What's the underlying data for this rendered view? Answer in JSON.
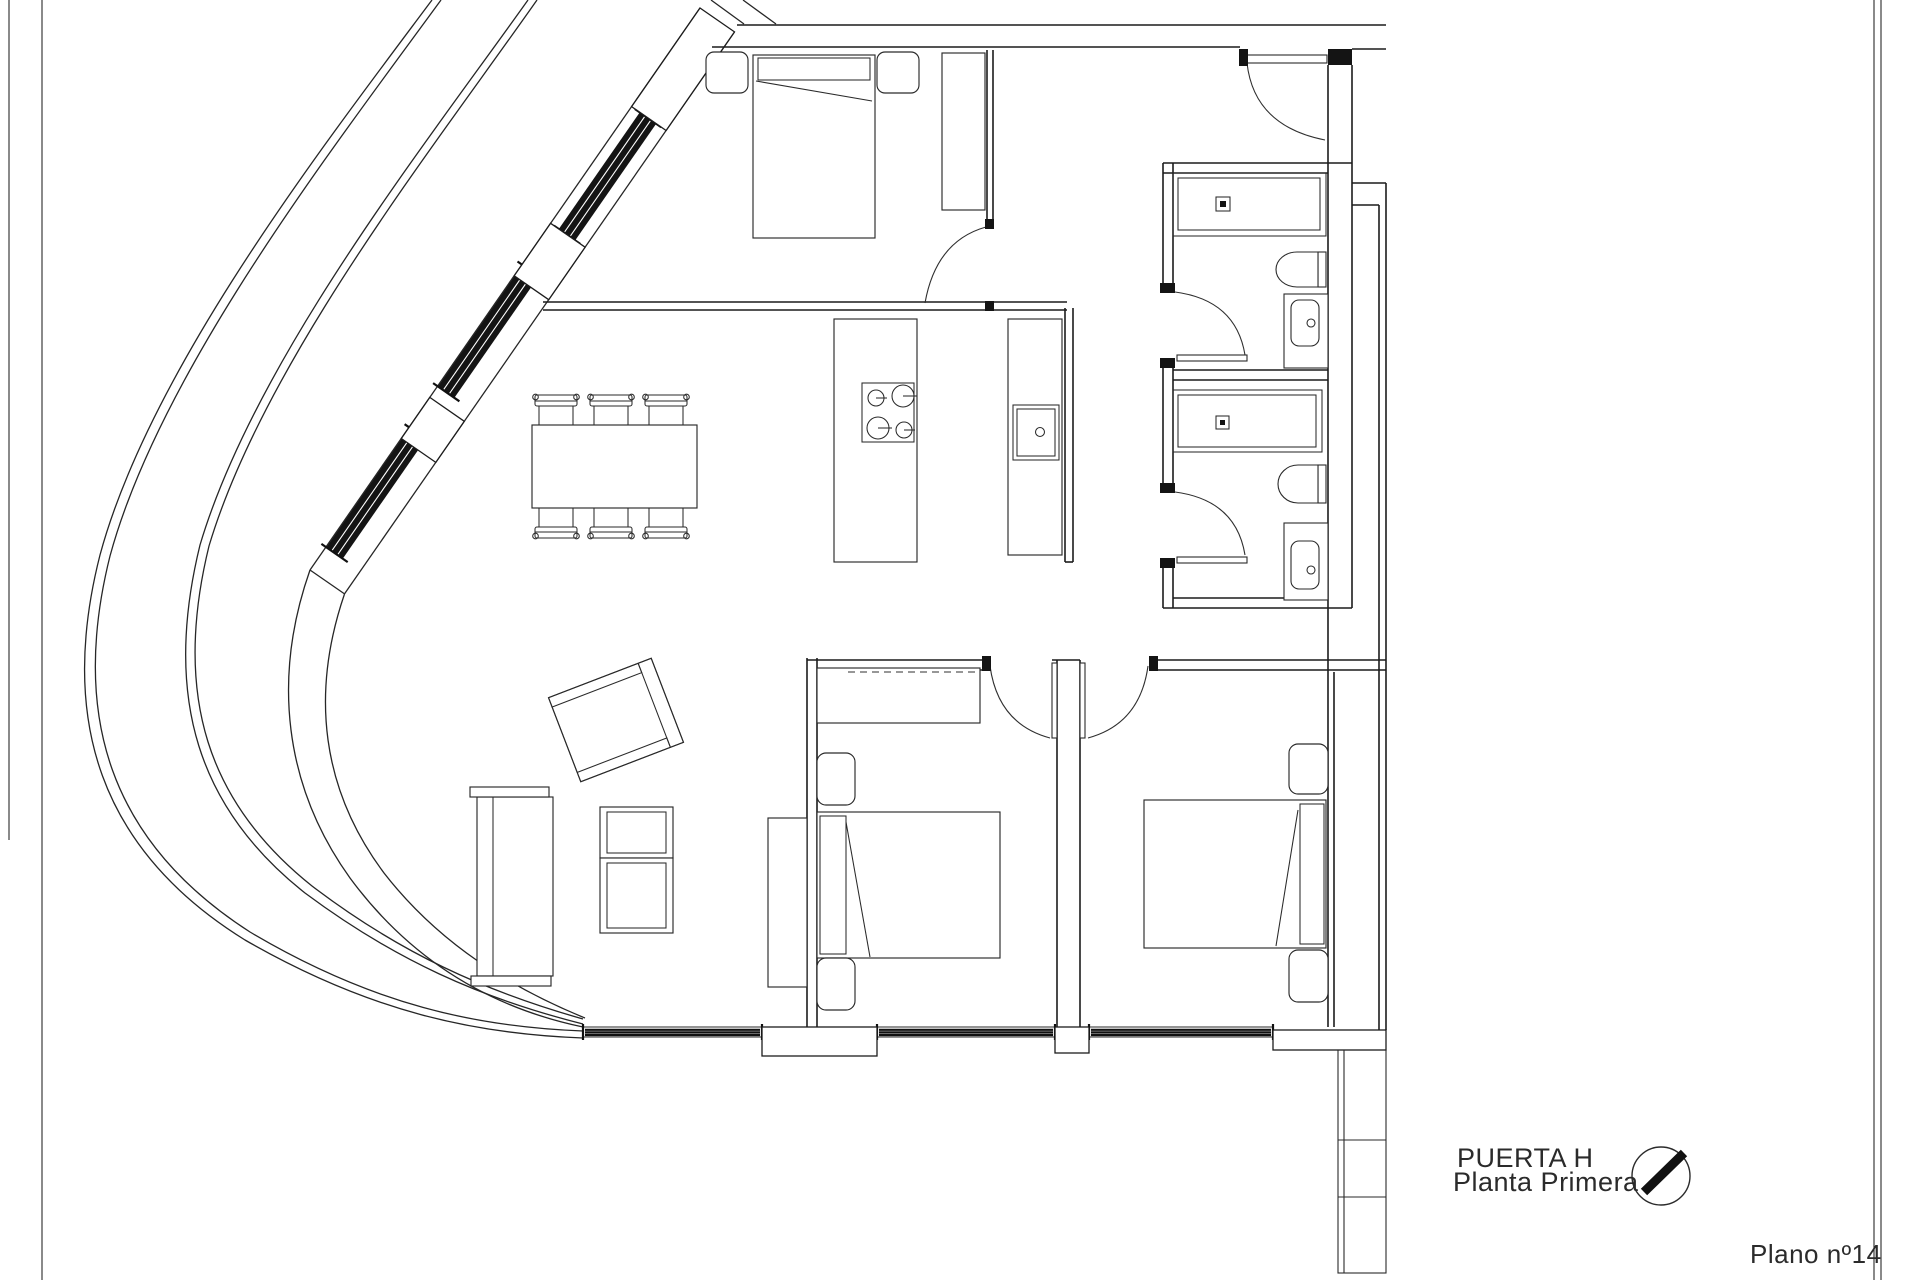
{
  "title_block": {
    "line1": "PUERTA H",
    "line2": "Planta Primera"
  },
  "sheet": {
    "plan_number": "Plano nº14"
  },
  "drawing": {
    "ink_color": "#1c1c1c",
    "background_color": "#ffffff",
    "window_glazing_color": "#141414"
  },
  "icons": {
    "north_arrow": "north-arrow-icon"
  }
}
